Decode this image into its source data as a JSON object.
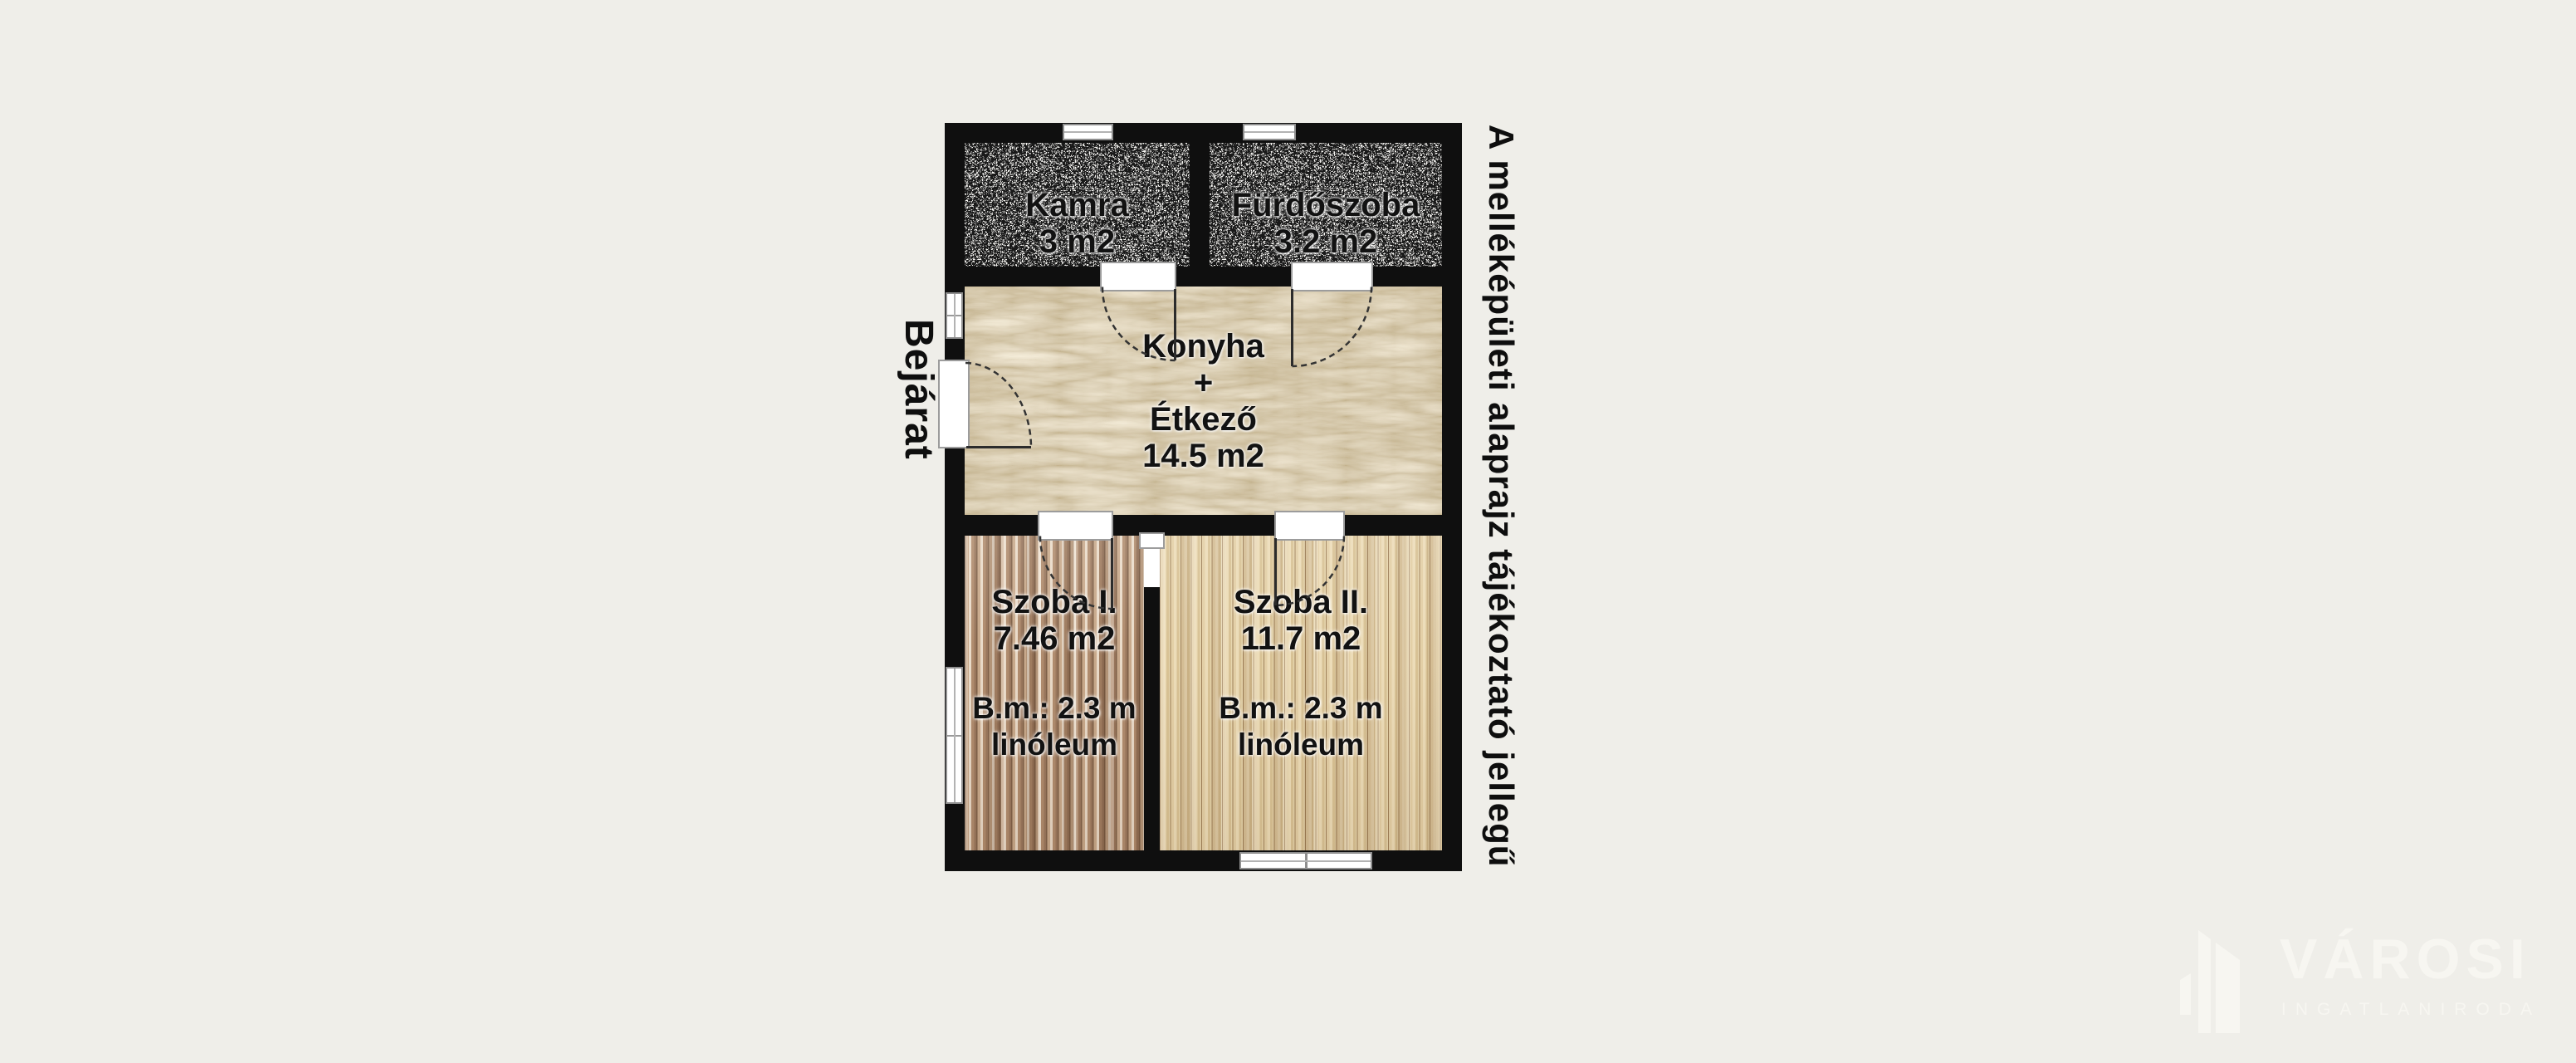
{
  "floorplan": {
    "rooms": {
      "kamra": {
        "name": "Kamra",
        "area": "3 m2"
      },
      "furdoszoba": {
        "name": "Fürdőszoba",
        "area": "3.2 m2"
      },
      "konyha": {
        "name": "Konyha",
        "plus": "+",
        "name2": "Étkező",
        "area": "14.5 m2"
      },
      "szoba1": {
        "name": "Szoba I.",
        "area": "7.46 m2",
        "ceiling": "B.m.: 2.3 m",
        "floor": "linóleum"
      },
      "szoba2": {
        "name": "Szoba II.",
        "area": "11.7 m2",
        "ceiling": "B.m.: 2.3 m",
        "floor": "linóleum"
      }
    },
    "entrance_label": "Bejárat",
    "disclaimer": "A melléképületi alaprajz tájékoztató jellegű"
  },
  "watermark": {
    "brand": "VÁROSI",
    "tagline": "INGATLANIRODA"
  },
  "colors": {
    "background": "#efeee9",
    "wall": "#0f0f0f",
    "label_text": "#121212",
    "kitchen_floor": "#d8c299",
    "watermark": "#f7f6f1"
  }
}
